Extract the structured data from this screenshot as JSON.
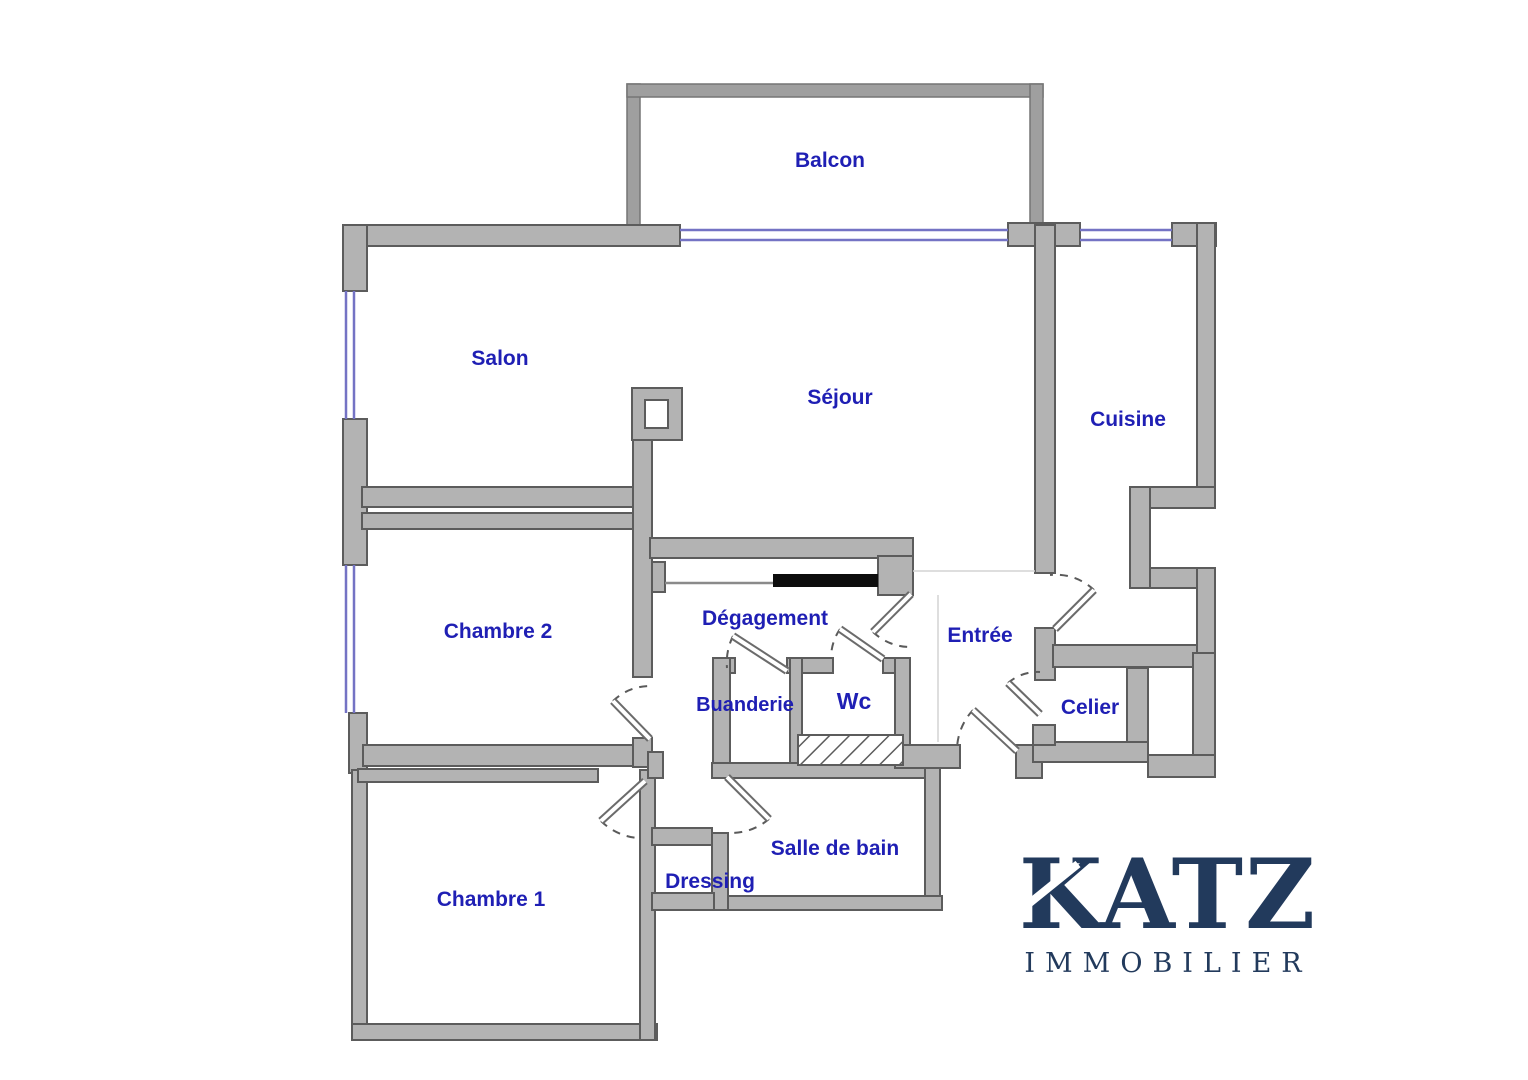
{
  "plan": {
    "background_color": "#ffffff",
    "wall_fill_color": "#b3b3b3",
    "wall_stroke_color": "#5c5c5c",
    "window_color": "#7473c4",
    "label_color": "#1f1fb4",
    "sliding_door_color": "#0d0d0d",
    "rooms": {
      "balcon": "Balcon",
      "salon": "Salon",
      "sejour": "Séjour",
      "cuisine": "Cuisine",
      "chambre2": "Chambre 2",
      "degagement": "Dégagement",
      "entree": "Entrée",
      "buanderie": "Buanderie",
      "wc": "Wc",
      "celier": "Celier",
      "chambre1": "Chambre 1",
      "dressing": "Dressing",
      "salle_de_bain": "Salle de bain"
    },
    "logo": {
      "name": "KATZ",
      "tagline": "IMMOBILIER",
      "color": "#223a5c"
    }
  }
}
